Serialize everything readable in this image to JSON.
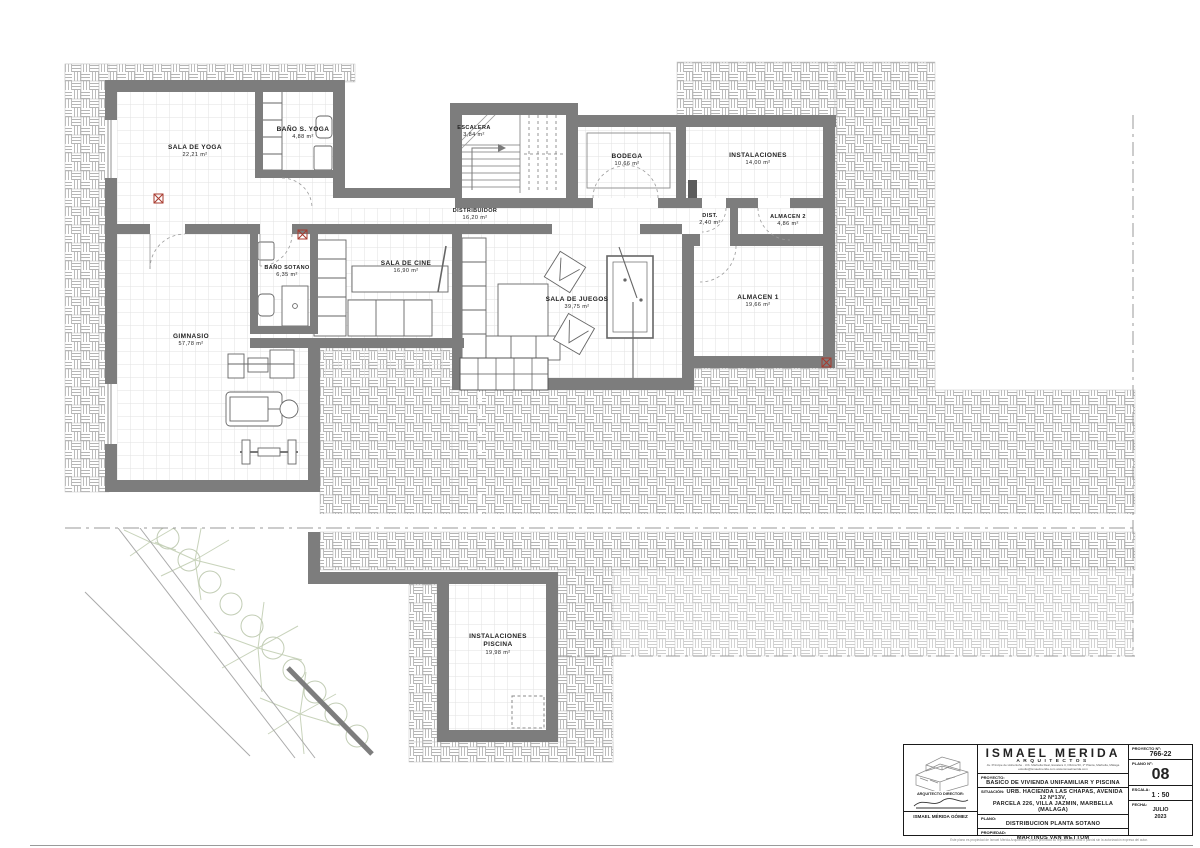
{
  "rooms": [
    {
      "name": "SALA DE YOGA",
      "area": "22,21 m²"
    },
    {
      "name": "BAÑO S. YOGA",
      "area": "4,88 m²"
    },
    {
      "name": "ESCALERA",
      "area": "3,84 m²"
    },
    {
      "name": "BODEGA",
      "area": "10,66 m²"
    },
    {
      "name": "INSTALACIONES",
      "area": "14,00 m²"
    },
    {
      "name": "DISTRIBUIDOR",
      "area": "16,20 m²"
    },
    {
      "name": "DIST.",
      "area": "2,40 m²"
    },
    {
      "name": "ALMACEN 2",
      "area": "4,86 m²"
    },
    {
      "name": "BAÑO SOTANO",
      "area": "6,35 m²"
    },
    {
      "name": "SALA DE CINE",
      "area": "16,90 m²"
    },
    {
      "name": "SALA DE JUEGOS",
      "area": "39,75 m²"
    },
    {
      "name": "ALMACEN 1",
      "area": "19,66 m²"
    },
    {
      "name": "GIMNASIO",
      "area": "57,78 m²"
    },
    {
      "name": "INSTALACIONES",
      "name2": "PISCINA",
      "area": "19,98 m²"
    }
  ],
  "title_block": {
    "firm_name": "ISMAEL MERIDA",
    "firm_subtitle": "ARQUITECTOS",
    "address_line": "Av. Príncipe de Hohenlohe · Urb. Marbella Real, Escalera 3, Oficina 50, 1ª Planta, Marbella, Málaga",
    "contact_line": "estudio@ismaelmerida.com          www.ismaelmerida.com",
    "proyecto_label": "PROYECTO:",
    "proyecto": "BASICO DE VIVIENDA UNIFAMILIAR Y PISCINA",
    "situacion_label": "SITUACIÓN:",
    "situacion_1": "URB. HACIENDA LAS CHAPAS, AVENIDA 12 Nº13V,",
    "situacion_2": "PARCELA 226, VILLA JAZMIN, MARBELLA (MALAGA)",
    "plano_label": "PLANO:",
    "plano": "DISTRIBUCION PLANTA SOTANO",
    "propiedad_label": "PROPIEDAD:",
    "propiedad": "MARTINUS VAN WETTUM",
    "proyecto_no_label": "PROYECTO Nº:",
    "proyecto_no": "766-22",
    "plano_no_label": "PLANO Nº:",
    "plano_no": "08",
    "escala_label": "ESCALA:",
    "escala": "1 : 50",
    "fecha_label": "FECHA:",
    "fecha_month": "JULIO",
    "fecha_year": "2023",
    "director_label": "ARQUITECTO DIRECTOR:",
    "director_name": "ISMAEL MÉRIDA GÓMEZ"
  },
  "footer_note": "Este plano es propiedad de Ismael Mérida Arquitectos. Queda prohibida su reproducción total o parcial sin la autorización expresa del autor.",
  "colors": {
    "wall": "#7d7d7d",
    "hatch_line": "#b5b5b5",
    "floor_grid": "#e2e2e2",
    "accent_red": "#a83a2e",
    "vegetation_green": "#c8d3bb"
  }
}
